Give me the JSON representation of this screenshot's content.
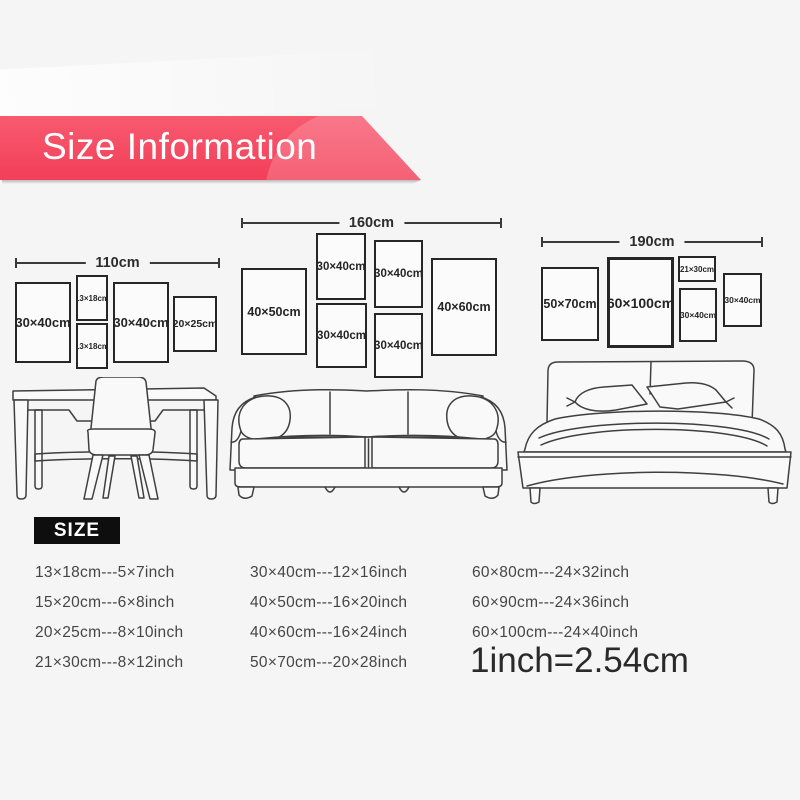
{
  "header": {
    "title": "Size Information"
  },
  "clusters": [
    {
      "width_label": "110cm",
      "frames": [
        {
          "label": "30×40cm"
        },
        {
          "label": "13×18cm"
        },
        {
          "label": "13×18cm"
        },
        {
          "label": "30×40cm"
        },
        {
          "label": "20×25cm"
        }
      ]
    },
    {
      "width_label": "160cm",
      "frames": [
        {
          "label": "40×50cm"
        },
        {
          "label": "30×40cm"
        },
        {
          "label": "30×40cm"
        },
        {
          "label": "30×40cm"
        },
        {
          "label": "30×40cm"
        },
        {
          "label": "40×60cm"
        }
      ]
    },
    {
      "width_label": "190cm",
      "frames": [
        {
          "label": "50×70cm"
        },
        {
          "label": "60×100cm"
        },
        {
          "label": "21×30cm"
        },
        {
          "label": "30×40cm"
        },
        {
          "label": "30×40cm"
        }
      ]
    }
  ],
  "size_table": {
    "heading": "SIZE",
    "col1": [
      "13×18cm---5×7inch",
      "15×20cm---6×8inch",
      "20×25cm---8×10inch",
      "21×30cm---8×12inch"
    ],
    "col2": [
      "30×40cm---12×16inch",
      "40×50cm---16×20inch",
      "40×60cm---16×24inch",
      "50×70cm---20×28inch"
    ],
    "col3": [
      "60×80cm---24×32inch",
      "60×90cm---24×36inch",
      "60×100cm---24×40inch"
    ],
    "note": "1inch=2.54cm"
  },
  "colors": {
    "background": "#f5f5f5",
    "accent_red": "#f4465e",
    "badge_black": "#0e0e0e",
    "line_dark": "#3f3f3f"
  }
}
